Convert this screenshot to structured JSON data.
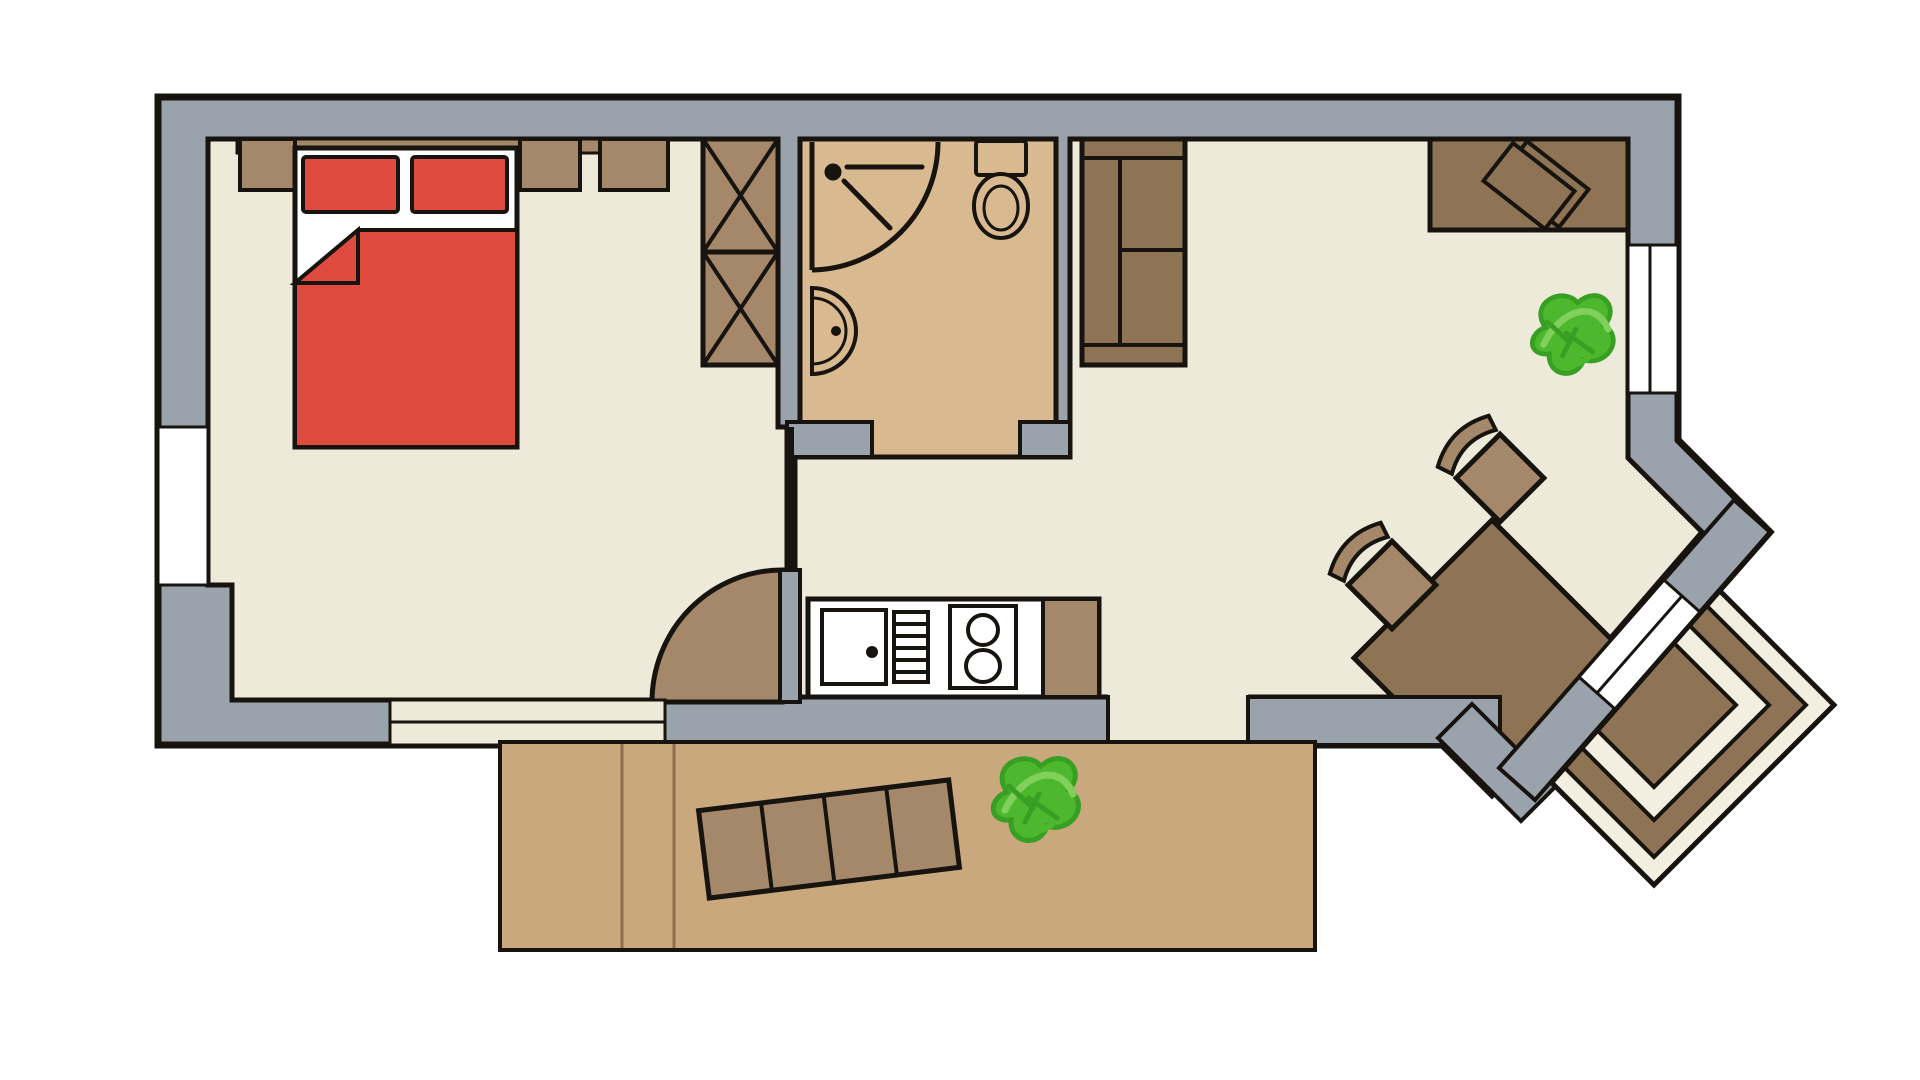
{
  "title": "apartment-floor-plan",
  "colors": {
    "background": "#ffffff",
    "wall": "#9aa2ab",
    "line": "#17130e",
    "room_floor": "#eeead9",
    "bathroom_floor": "#d8b990",
    "terrace_floor": "#c9a87e",
    "deck_cream": "#f3efe0",
    "deck_line": "#8b6f50",
    "furniture_light": "#a5886a",
    "furniture_dark": "#8e7455",
    "bed_red": "#e04b3f",
    "white": "#ffffff",
    "plant_green": "#4db82e",
    "plant_green_light": "#82d05c",
    "plant_green_dark": "#379f22"
  },
  "scene": {
    "type": "top-down apartment floor plan, no text labels",
    "rooms": [
      {
        "name": "bedroom",
        "objects": [
          "headboard-shelf",
          "nightstand-left",
          "nightstand-right",
          "dresser",
          "double-bed",
          "pillow-left",
          "pillow-right",
          "red-blanket-with-folded-corner",
          "wardrobe-two-x-boxes",
          "side-window-left",
          "south-window",
          "door-to-hall"
        ]
      },
      {
        "name": "bathroom",
        "objects": [
          "corner-shower-with-curved-screen",
          "shower-head-symbol",
          "wall-basin",
          "toilet-with-cistern",
          "doorway"
        ]
      },
      {
        "name": "hall-kitchen",
        "objects": [
          "kitchen-counter",
          "sink-basin-with-drain",
          "drainer-grate",
          "two-burner-stove",
          "counter-end-cabinet",
          "terrace-doorway"
        ]
      },
      {
        "name": "living-room",
        "objects": [
          "shelving-unit",
          "desk",
          "laptop",
          "potted-plant",
          "dining-table-rotated",
          "chair-upper",
          "chair-lower",
          "bay-window-right",
          "diagonal-terrace-door"
        ]
      },
      {
        "name": "south-terrace",
        "objects": [
          "deck-plank-lines",
          "slatted-bench",
          "potted-plant"
        ]
      },
      {
        "name": "corner-deck",
        "objects": [
          "nested-diamond-deck-rings"
        ]
      }
    ]
  }
}
